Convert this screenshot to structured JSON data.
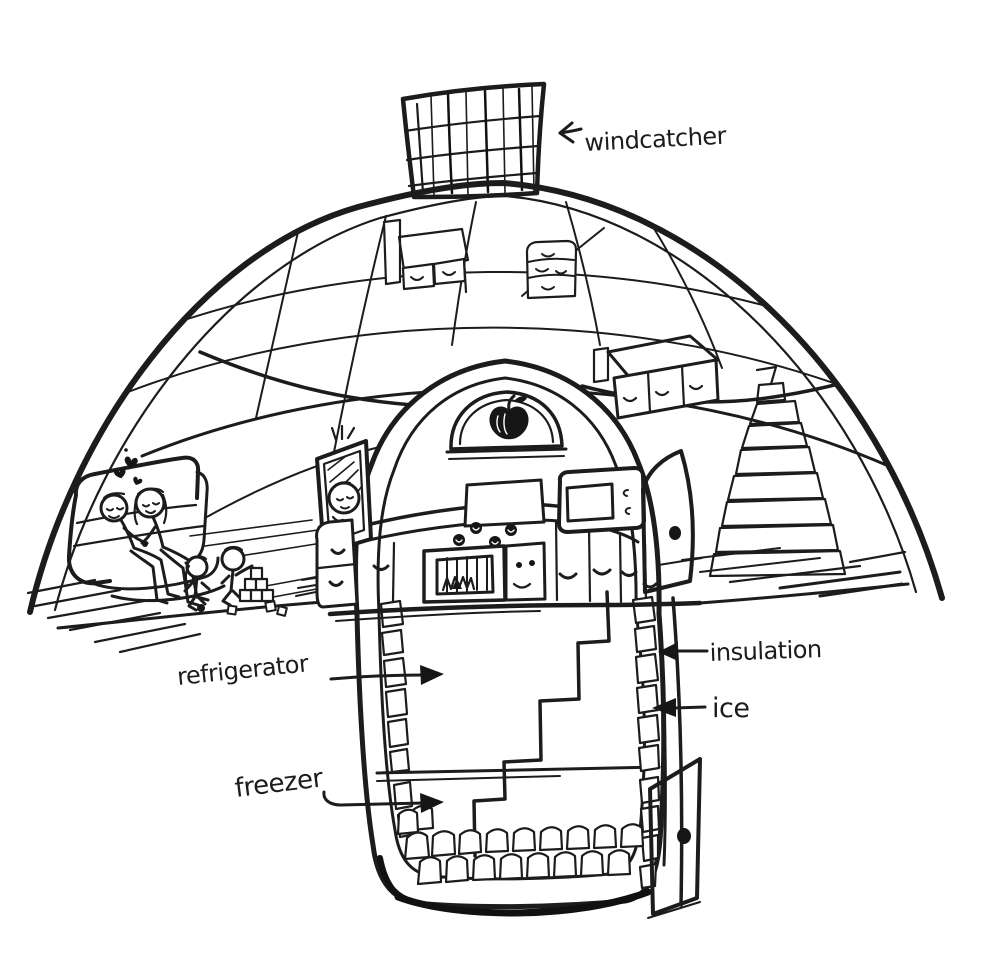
{
  "canvas": {
    "width": 1000,
    "height": 964,
    "background": "#ffffff",
    "ink": "#1c1c1c"
  },
  "labels": {
    "windcatcher": "windcatcher",
    "refrigerator": "refrigerator",
    "insulation": "insulation",
    "ice": "ice",
    "freezer": "freezer"
  },
  "icons": {
    "windcatcher_arrow": "left-arrow",
    "refrigerator_arrow": "right-arrow",
    "insulation_arrow": "left-arrow",
    "ice_arrow": "left-arrow",
    "freezer_arrow": "right-arrow",
    "apple": "apple",
    "hearts": "hearts"
  }
}
